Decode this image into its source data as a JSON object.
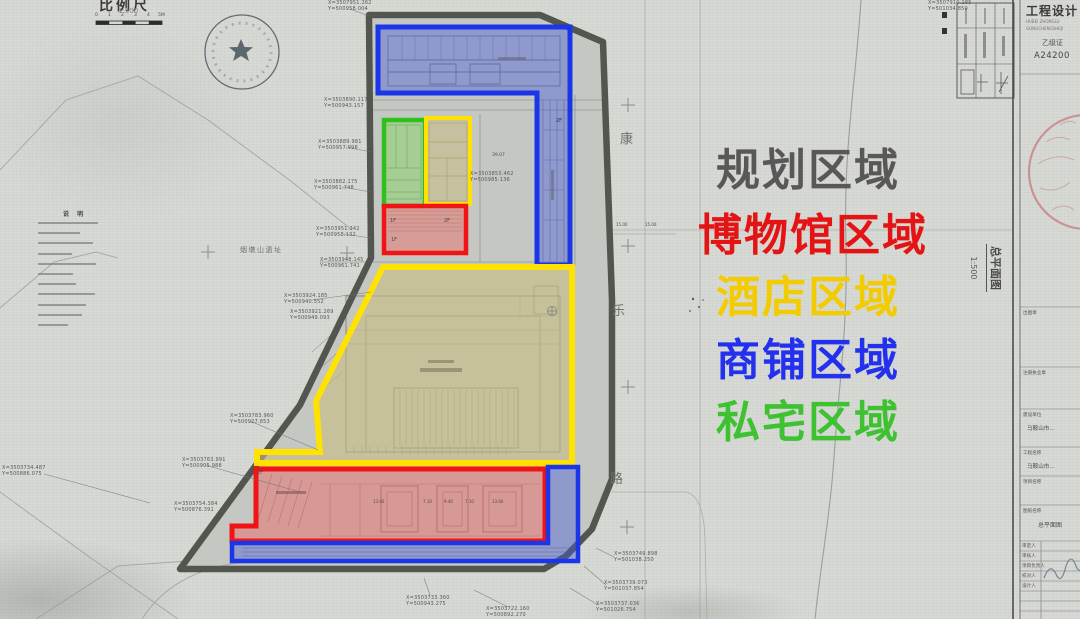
{
  "scale_bar": {
    "label": "比例尺",
    "ratio": "1:500",
    "ticks": [
      "0",
      "1",
      "2",
      "3",
      "4",
      "5M"
    ]
  },
  "legend": {
    "items": [
      {
        "label": "规划区域",
        "color": "#585858"
      },
      {
        "label": "博物馆区域",
        "color": "#e41414"
      },
      {
        "label": "酒店区域",
        "color": "#f2cc00"
      },
      {
        "label": "商铺区域",
        "color": "#2330ee"
      },
      {
        "label": "私宅区域",
        "color": "#3ec232"
      }
    ]
  },
  "drawing_title": {
    "name": "总平面图",
    "scale": "1:500"
  },
  "road_name": {
    "c1": "康",
    "c2": "乐",
    "c3": "路"
  },
  "site_label": "烟墩山遗址",
  "notes": {
    "header": "说 明",
    "line_count": 11
  },
  "plan": {
    "f1": "1F",
    "f2": "2F",
    "red_dims": [
      "13.60",
      "7.10",
      "9.40",
      "7.10",
      "13.60"
    ],
    "dim_a": "39.07",
    "dim_b": "15.00",
    "dim_c": "15.00"
  },
  "zone_colors": {
    "shops": "#1b35e8",
    "museum": "#f01414",
    "hotel": "#ffe200",
    "residence": "#2fc01c",
    "boundary": "#53564f"
  },
  "coordinates": [
    {
      "x": 328,
      "y": 1,
      "l1": "X=3507951.262",
      "l2": "Y=500958.004"
    },
    {
      "x": 928,
      "y": 1,
      "l1": "X=3507910.185",
      "l2": "Y=501034.850"
    },
    {
      "x": 324,
      "y": 98,
      "l1": "X=3503890.117",
      "l2": "Y=500943.157"
    },
    {
      "x": 318,
      "y": 140,
      "l1": "X=3503889.981",
      "l2": "Y=500957.998"
    },
    {
      "x": 314,
      "y": 180,
      "l1": "X=3503882.175",
      "l2": "Y=500961.748"
    },
    {
      "x": 316,
      "y": 227,
      "l1": "X=3503951.342",
      "l2": "Y=500958.132"
    },
    {
      "x": 320,
      "y": 258,
      "l1": "X=3503948.145",
      "l2": "Y=500961.741"
    },
    {
      "x": 284,
      "y": 294,
      "l1": "X=3503924.185",
      "l2": "Y=500940.552"
    },
    {
      "x": 290,
      "y": 310,
      "l1": "X=3503921.269",
      "l2": "Y=500949.093"
    },
    {
      "x": 230,
      "y": 414,
      "l1": "X=3503783.960",
      "l2": "Y=500927.853"
    },
    {
      "x": 182,
      "y": 458,
      "l1": "X=3503763.991",
      "l2": "Y=500905.988"
    },
    {
      "x": 174,
      "y": 502,
      "l1": "X=3503754.384",
      "l2": "Y=500876.391"
    },
    {
      "x": 2,
      "y": 466,
      "l1": "X=3503734.487",
      "l2": "Y=500886.075"
    },
    {
      "x": 406,
      "y": 596,
      "l1": "X=3503733.360",
      "l2": "Y=500943.275"
    },
    {
      "x": 486,
      "y": 607,
      "l1": "X=3503722.160",
      "l2": "Y=500892.270"
    },
    {
      "x": 614,
      "y": 552,
      "l1": "X=3503749.898",
      "l2": "Y=501038.250"
    },
    {
      "x": 604,
      "y": 581,
      "l1": "X=3503739.073",
      "l2": "Y=501037.854"
    },
    {
      "x": 596,
      "y": 602,
      "l1": "X=3503737.036",
      "l2": "Y=501026.754"
    },
    {
      "x": 470,
      "y": 172,
      "l1": "X=3503853.462",
      "l2": "Y=500985.136"
    }
  ],
  "title_block": {
    "header": "工程设计",
    "sub1": "HUBEI ZHONGLU",
    "sub2": "GONGCHENGSHEJI",
    "cert": "乙级证",
    "cert_no": "A24200",
    "rows": [
      {
        "label": "出图章",
        "value": ""
      },
      {
        "label": "注册执业章",
        "value": ""
      },
      {
        "label": "建设单位",
        "value": "马鞍山市…"
      },
      {
        "label": "工程名称",
        "value": "马鞍山市…"
      },
      {
        "label": "项目名称",
        "value": ""
      },
      {
        "label": "图纸名称",
        "value": "总平面图"
      }
    ],
    "sign_rows": [
      "审定人",
      "审核人",
      "项目负责人",
      "校对人",
      "设计人"
    ]
  }
}
